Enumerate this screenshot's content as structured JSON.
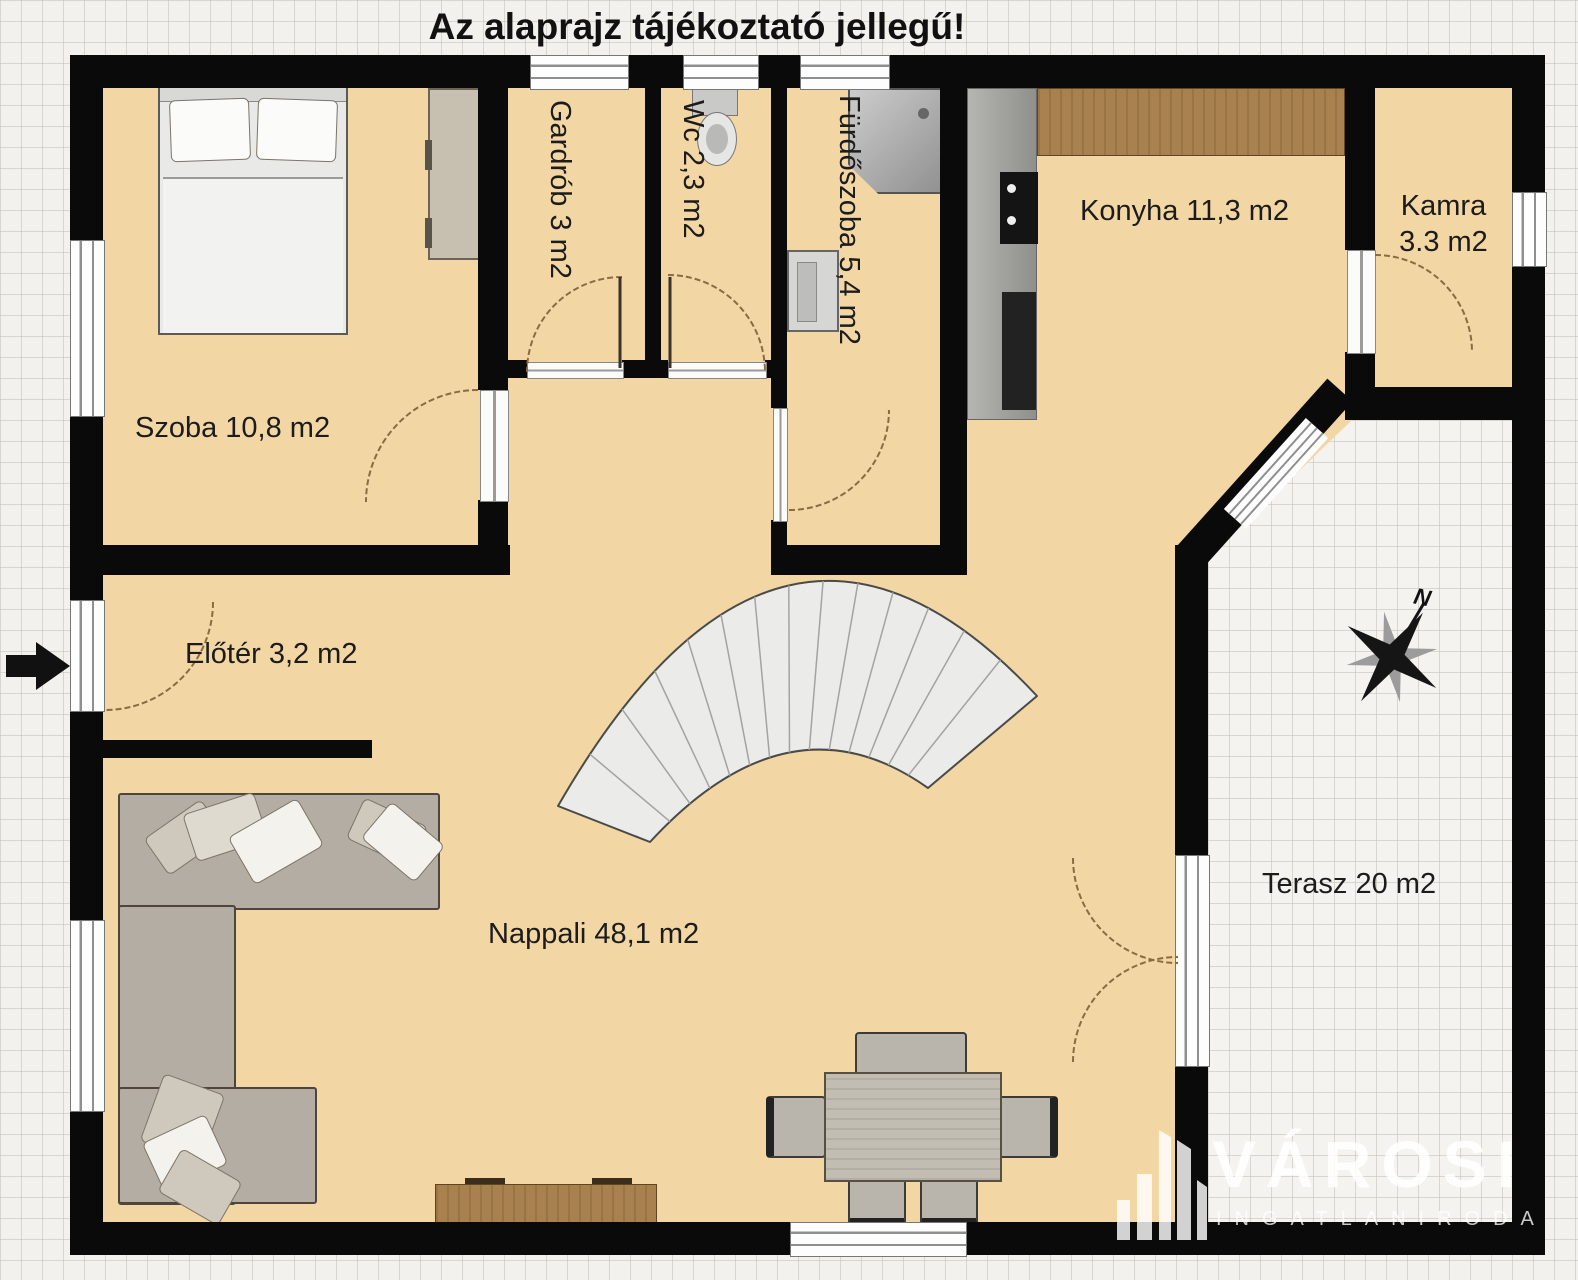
{
  "title": "Az alaprajz tájékoztató jellegű!",
  "rooms": {
    "szoba": "Szoba 10,8 m2",
    "gardrob": "Gardrób 3 m2",
    "wc": "Wc 2,3 m2",
    "furdoszoba": "Fürdőszoba 5,4 m2",
    "konyha": "Konyha 11,3 m2",
    "kamra_line1": "Kamra",
    "kamra_line2": "3.3 m2",
    "eloter": "Előtér 3,2 m2",
    "nappali": "Nappali 48,1 m2",
    "terasz": "Terasz 20 m2"
  },
  "compass": {
    "north": "N"
  },
  "watermark": {
    "brand": "VÁROSI",
    "subtitle": "INGATLANIRODA"
  },
  "colors": {
    "wall": "#0a0a0a",
    "floor": "#f2d6a4",
    "wood": "#a8814f",
    "sofa": "#b3ada3",
    "stair": "#ebebe9"
  }
}
